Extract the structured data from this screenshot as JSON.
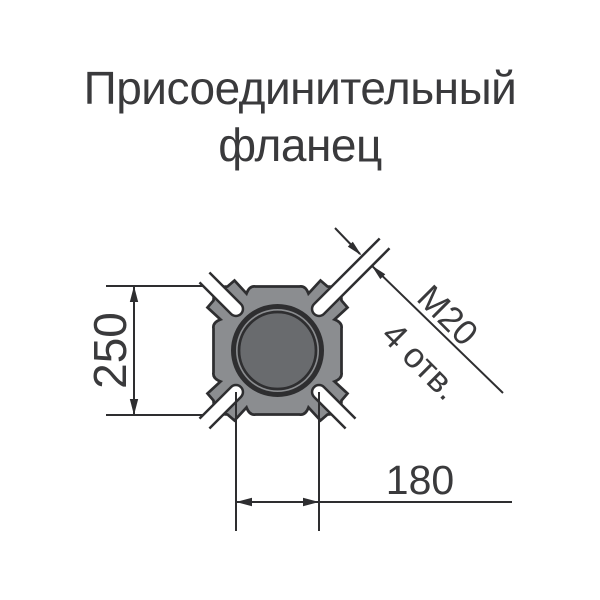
{
  "title": {
    "line1": "Присоединительный",
    "line2": "фланец"
  },
  "drawing": {
    "name": "flange-cross-section",
    "dimensions": {
      "height": "250",
      "holes_spacing": "180"
    },
    "callout": {
      "thread": "М20",
      "holes": "4 отв."
    },
    "colors": {
      "body_fill": "#8b8d90",
      "bore_fill": "#696b6e",
      "outline": "#2e2e30",
      "text": "#3a3a3c",
      "background": "#ffffff"
    }
  }
}
